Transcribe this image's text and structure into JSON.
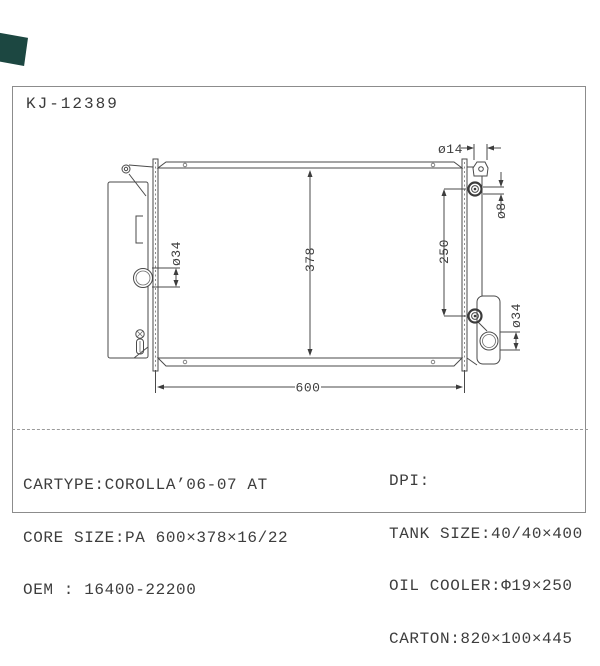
{
  "page": {
    "title": "KJ-12389"
  },
  "drawing": {
    "subject": "radiator-front-view",
    "dim_core_width": "600",
    "dim_core_height": "378",
    "dim_bracket_pitch": "250",
    "dim_filler_neck": "ø14",
    "dim_mount_bolt": "ø8",
    "dim_inlet_pipe": "ø34",
    "dim_outlet_pipe": "ø34"
  },
  "spec_table": {
    "left_column": [
      "CARTYPE:COROLLA’06-07 AT",
      "CORE SIZE:PA 600×378×16/22",
      "OEM : 16400-22200"
    ],
    "right_column": [
      "DPI:",
      "TANK SIZE:40/40×400",
      "OIL COOLER:Φ19×250",
      "CARTON:820×100×445"
    ]
  },
  "colors": {
    "ribbon": "#1c4741",
    "line": "#4a4a4a",
    "text": "#3d3d3d",
    "border": "#8c8c8c"
  }
}
